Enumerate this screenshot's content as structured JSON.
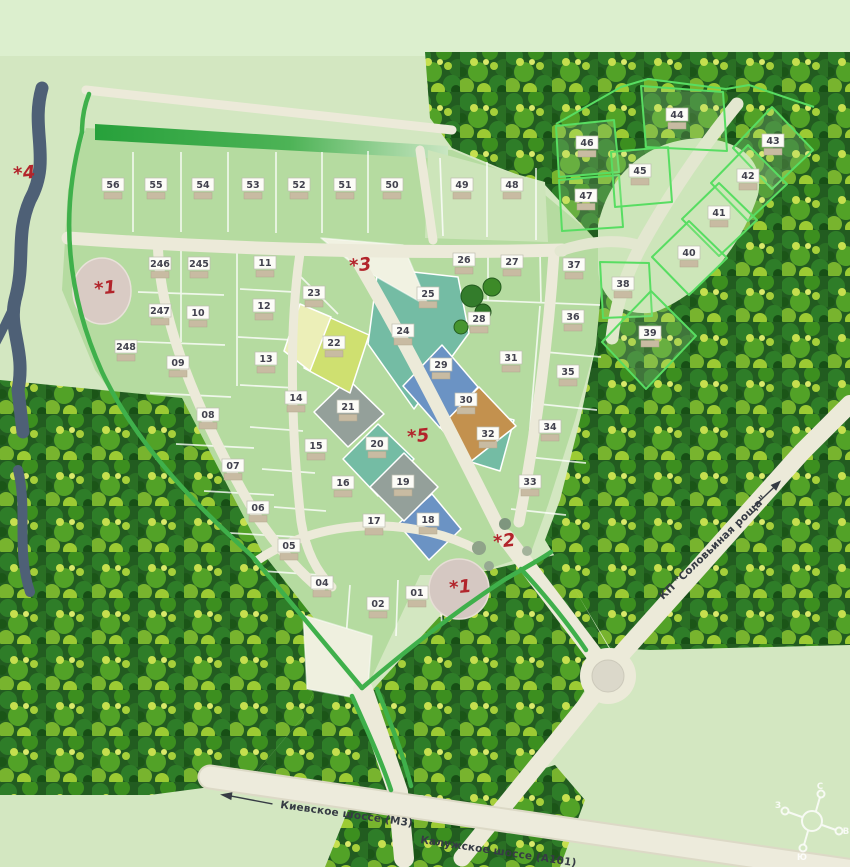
{
  "roads": {
    "highway_left": "Киевское шоссе (М3)",
    "highway_right": "Калужское шоссе (А101)",
    "neighbor_settlement": "КП \"Соловьиная роща\""
  },
  "compass": {
    "n": "С",
    "e": "В",
    "s": "Ю",
    "w": "З"
  },
  "markers": [
    {
      "label": "*4",
      "x": 14,
      "y": 180
    },
    {
      "label": "*1",
      "x": 95,
      "y": 295
    },
    {
      "label": "*3",
      "x": 350,
      "y": 272
    },
    {
      "label": "*5",
      "x": 408,
      "y": 443
    },
    {
      "label": "*2",
      "x": 494,
      "y": 548
    },
    {
      "label": "*1",
      "x": 450,
      "y": 594
    }
  ],
  "colors": {
    "background": "#d3e7c1",
    "plot_base": "#b5dba0",
    "road": "#ecead9",
    "river": "#4e6076",
    "forest": "#2a6b24",
    "marker_red": "#b2242b",
    "teal_plot": "#74bca4",
    "blue_plot": "#6b93c4",
    "brown_plot": "#c3914e",
    "gray_plot": "#94a09a",
    "yellow_plot": "#cfe070",
    "outline_plot_stroke": "#58dd62"
  },
  "plots": [
    {
      "n": "56",
      "x": 113,
      "y": 190
    },
    {
      "n": "55",
      "x": 156,
      "y": 190
    },
    {
      "n": "54",
      "x": 203,
      "y": 190
    },
    {
      "n": "53",
      "x": 253,
      "y": 190
    },
    {
      "n": "52",
      "x": 299,
      "y": 190
    },
    {
      "n": "51",
      "x": 345,
      "y": 190
    },
    {
      "n": "50",
      "x": 392,
      "y": 190
    },
    {
      "n": "49",
      "x": 462,
      "y": 190
    },
    {
      "n": "48",
      "x": 512,
      "y": 190
    },
    {
      "n": "46",
      "x": 587,
      "y": 148,
      "color": "outline"
    },
    {
      "n": "47",
      "x": 586,
      "y": 201,
      "color": "outline"
    },
    {
      "n": "45",
      "x": 640,
      "y": 176,
      "color": "outline"
    },
    {
      "n": "44",
      "x": 677,
      "y": 120,
      "color": "outline"
    },
    {
      "n": "43",
      "x": 773,
      "y": 146,
      "color": "outline"
    },
    {
      "n": "42",
      "x": 748,
      "y": 181,
      "color": "outline"
    },
    {
      "n": "41",
      "x": 719,
      "y": 218,
      "color": "outline"
    },
    {
      "n": "40",
      "x": 689,
      "y": 258,
      "color": "outline"
    },
    {
      "n": "38",
      "x": 623,
      "y": 289,
      "color": "outline"
    },
    {
      "n": "39",
      "x": 650,
      "y": 338,
      "color": "outline"
    },
    {
      "n": "37",
      "x": 574,
      "y": 270
    },
    {
      "n": "36",
      "x": 573,
      "y": 322
    },
    {
      "n": "35",
      "x": 568,
      "y": 377
    },
    {
      "n": "34",
      "x": 550,
      "y": 432
    },
    {
      "n": "33",
      "x": 530,
      "y": 487
    },
    {
      "n": "26",
      "x": 464,
      "y": 265
    },
    {
      "n": "27",
      "x": 512,
      "y": 267
    },
    {
      "n": "25",
      "x": 428,
      "y": 299,
      "color": "teal"
    },
    {
      "n": "28",
      "x": 479,
      "y": 324
    },
    {
      "n": "24",
      "x": 403,
      "y": 336,
      "color": "teal"
    },
    {
      "n": "31",
      "x": 511,
      "y": 363
    },
    {
      "n": "29",
      "x": 441,
      "y": 370,
      "color": "blue"
    },
    {
      "n": "30",
      "x": 466,
      "y": 405,
      "color": "brown"
    },
    {
      "n": "32",
      "x": 488,
      "y": 439,
      "color": "teal"
    },
    {
      "n": "23",
      "x": 314,
      "y": 298
    },
    {
      "n": "22",
      "x": 334,
      "y": 348,
      "color": "yellow"
    },
    {
      "n": "21",
      "x": 348,
      "y": 412,
      "color": "gray"
    },
    {
      "n": "20",
      "x": 377,
      "y": 449,
      "color": "teal"
    },
    {
      "n": "19",
      "x": 403,
      "y": 487,
      "color": "gray"
    },
    {
      "n": "18",
      "x": 428,
      "y": 525,
      "color": "blue"
    },
    {
      "n": "17",
      "x": 374,
      "y": 526
    },
    {
      "n": "16",
      "x": 343,
      "y": 488
    },
    {
      "n": "15",
      "x": 316,
      "y": 451
    },
    {
      "n": "14",
      "x": 296,
      "y": 403
    },
    {
      "n": "13",
      "x": 266,
      "y": 364
    },
    {
      "n": "12",
      "x": 264,
      "y": 311
    },
    {
      "n": "11",
      "x": 265,
      "y": 268
    },
    {
      "n": "246",
      "x": 160,
      "y": 269
    },
    {
      "n": "245",
      "x": 199,
      "y": 269
    },
    {
      "n": "247",
      "x": 160,
      "y": 316
    },
    {
      "n": "10",
      "x": 198,
      "y": 318
    },
    {
      "n": "248",
      "x": 126,
      "y": 352
    },
    {
      "n": "09",
      "x": 178,
      "y": 368
    },
    {
      "n": "08",
      "x": 208,
      "y": 420
    },
    {
      "n": "07",
      "x": 233,
      "y": 471
    },
    {
      "n": "06",
      "x": 258,
      "y": 513
    },
    {
      "n": "05",
      "x": 289,
      "y": 551
    },
    {
      "n": "04",
      "x": 322,
      "y": 588
    },
    {
      "n": "02",
      "x": 378,
      "y": 609
    },
    {
      "n": "01",
      "x": 417,
      "y": 598
    }
  ]
}
